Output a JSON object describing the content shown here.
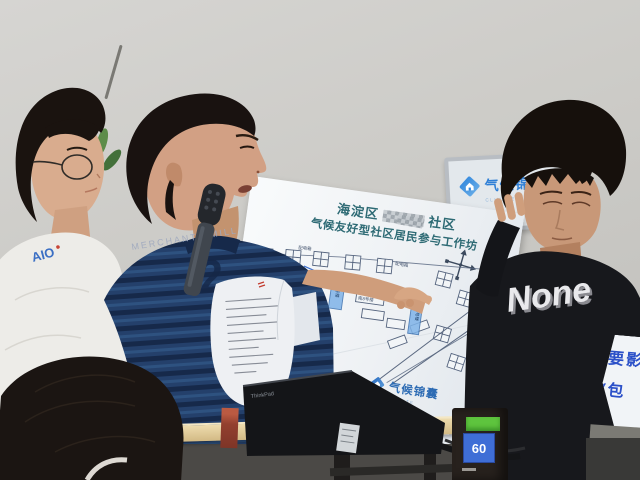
{
  "colors": {
    "poster_title": "#2d6a74",
    "brand_blue": "#2f7fd6",
    "map_highlight": "#7fb3e8",
    "slide_text_blue": "#2b50c8",
    "receiver_green": "#5ec43e",
    "receiver_blue": "#3f6ed6"
  },
  "poster": {
    "title_line1_prefix": "海淀区",
    "title_line1_suffix": "社区",
    "title_line2": "气候友好型社区居民参与工作坊",
    "brand": "气候锦囊",
    "brand_tagline": "CLIMATE",
    "map_labels": [
      "配电箱",
      "配电箱",
      "南7号楼",
      "南8号楼",
      "南9号楼",
      "10号楼",
      "11号楼"
    ]
  },
  "wall_monitor": {
    "brand": "气候锦囊",
    "tagline": "CLIMATE"
  },
  "side_screen": {
    "line1": "要影",
    "line2": "(包"
  },
  "presenter": {
    "shirt_text": "MERCHANTS MILL",
    "shirt_numeral": "2"
  },
  "left_person": {
    "shirt_graphic": "AIO"
  },
  "right_person": {
    "shirt_graphic": "None"
  },
  "receiver": {
    "display_value": "60"
  },
  "laptop": {
    "brand": "ThinkPad"
  }
}
